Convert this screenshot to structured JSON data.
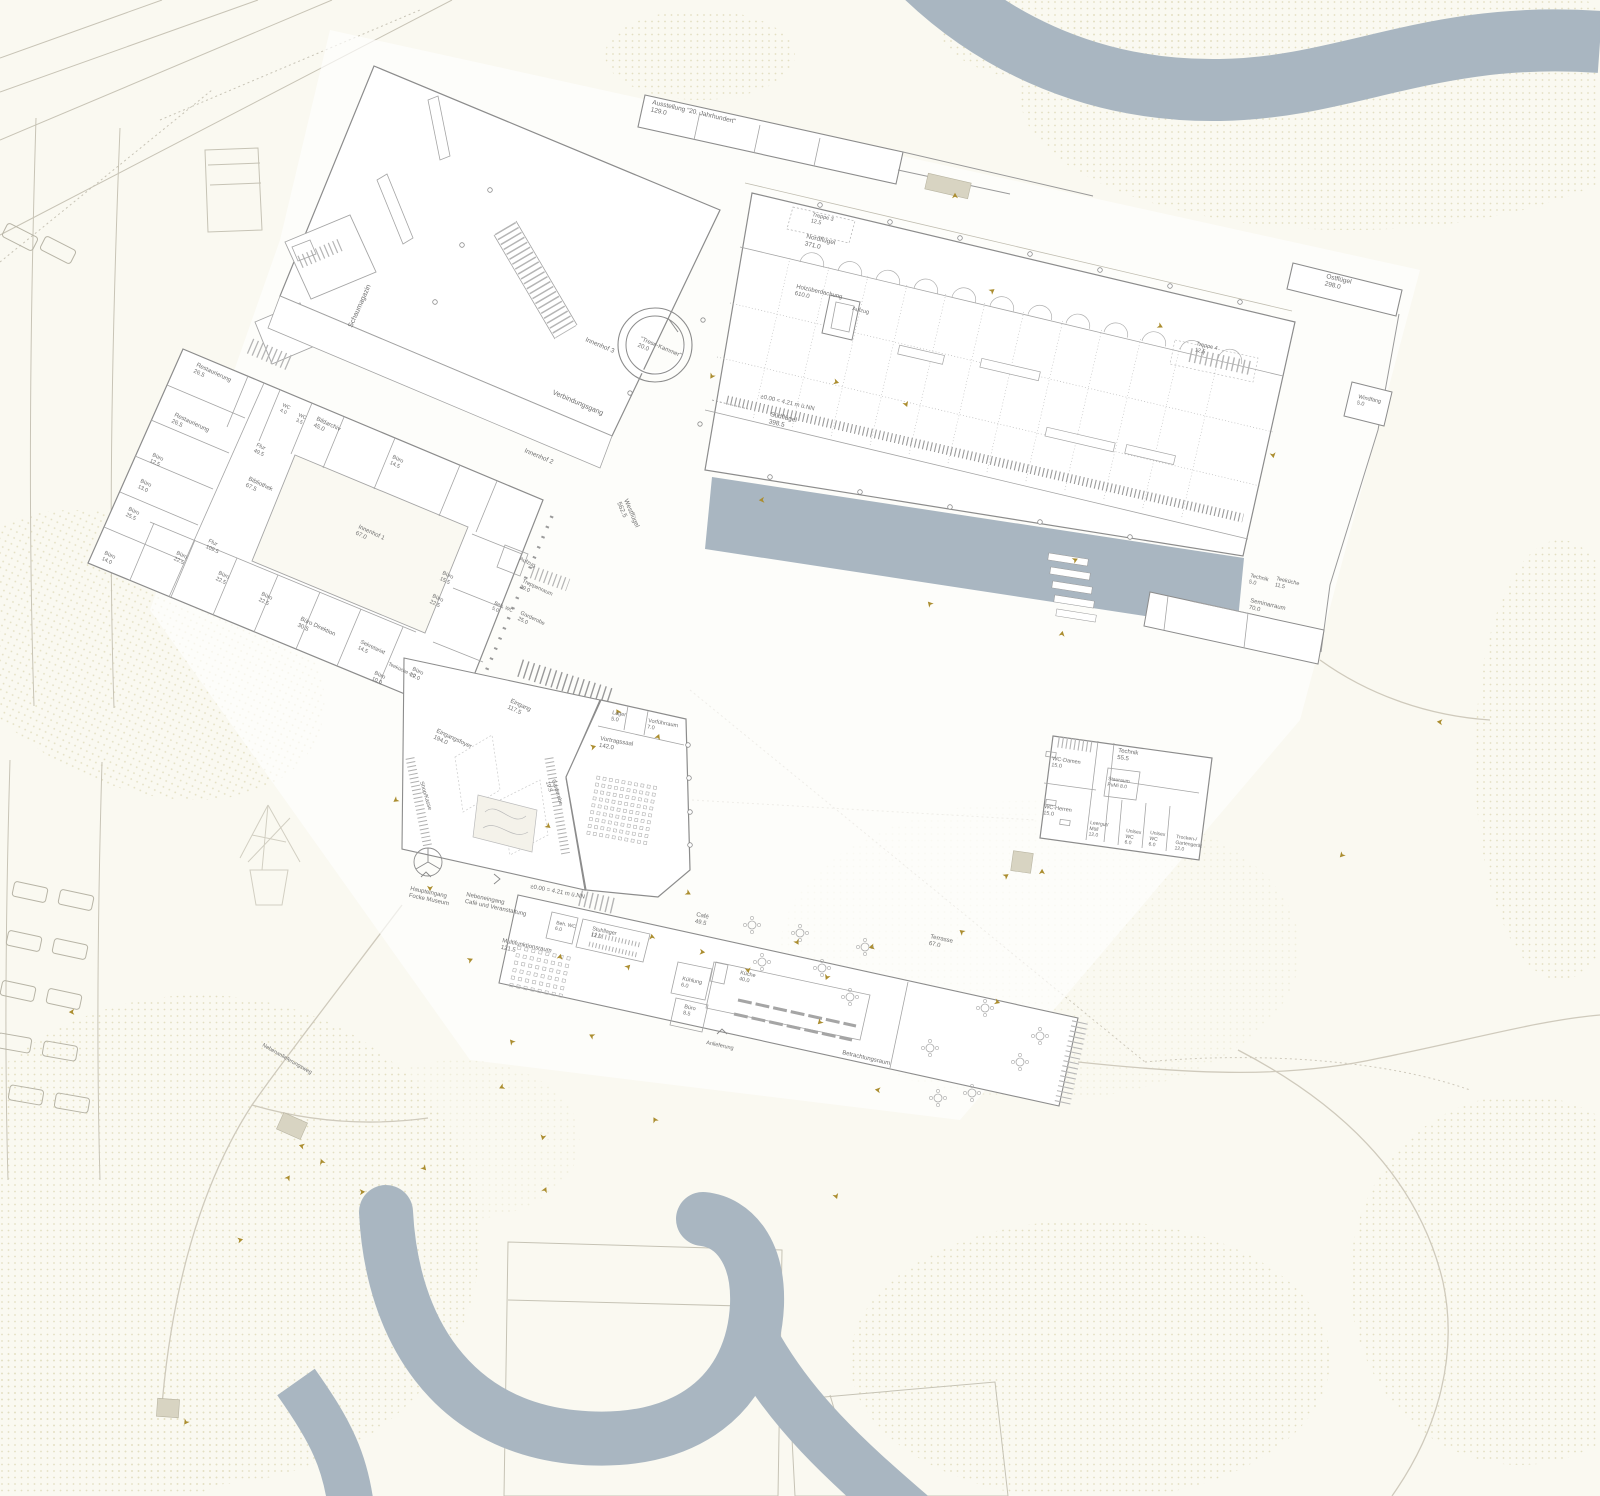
{
  "drawing": {
    "type": "architectural-site-plan",
    "elevation_note": "±0.00 = 4.21 m ü.NN"
  },
  "colors": {
    "paper": "#faf9f1",
    "water": "#a9b6c1",
    "building_fill": "#ffffff",
    "wall_stroke": "#8c8c8c",
    "inner_stroke": "#a5a5a5",
    "faint_stroke": "#c8c4b6",
    "dots": "#e3dfc2",
    "label": "#6e6e6e",
    "marker": "#ab8d2f",
    "shed_fill": "#d8d4c2"
  },
  "labels": [
    {
      "t": "Schaumagazin",
      "x": 352,
      "y": 328,
      "r": -66,
      "s": 7
    },
    {
      "t": "Innenhof 3",
      "x": 585,
      "y": 341,
      "r": 23,
      "s": 6.5
    },
    {
      "t": "Verbindungsgang",
      "x": 552,
      "y": 394,
      "r": 23,
      "s": 7
    },
    {
      "t": "Innenhof 2",
      "x": 524,
      "y": 452,
      "r": 23,
      "s": 6.5
    },
    {
      "t": "\"Trese-Kammer\"\n20.0",
      "x": 640,
      "y": 340,
      "r": 23,
      "s": 6
    },
    {
      "t": "Ausstellung \"20. Jahrhundert\"\n129.0",
      "x": 652,
      "y": 104,
      "r": 13,
      "s": 6.5
    },
    {
      "t": "Treppe 3\n12.5",
      "x": 812,
      "y": 216,
      "r": 13,
      "s": 5.5
    },
    {
      "t": "Nordflügel\n371.0",
      "x": 806,
      "y": 238,
      "r": 13,
      "s": 6.5
    },
    {
      "t": "Holzüberdachung\n610.0",
      "x": 796,
      "y": 288,
      "r": 13,
      "s": 6
    },
    {
      "t": "Aufzug",
      "x": 852,
      "y": 310,
      "r": 13,
      "s": 5.5
    },
    {
      "t": "±0.00 = 4.21 m ü.NN",
      "x": 760,
      "y": 398,
      "r": 13,
      "s": 6
    },
    {
      "t": "Südflügel\n398.5",
      "x": 770,
      "y": 416,
      "r": 13,
      "s": 6.5
    },
    {
      "t": "Treppe 4\n12.5",
      "x": 1196,
      "y": 345,
      "r": 13,
      "s": 5.5
    },
    {
      "t": "Ostflügel\n298.0",
      "x": 1326,
      "y": 278,
      "r": 13,
      "s": 6.5
    },
    {
      "t": "Windfang\n5.0",
      "x": 1358,
      "y": 398,
      "r": 13,
      "s": 5.5
    },
    {
      "t": "Technik\n5.0",
      "x": 1250,
      "y": 577,
      "r": 13,
      "s": 5.5
    },
    {
      "t": "Teeküche\n11.5",
      "x": 1276,
      "y": 580,
      "r": 13,
      "s": 5.5
    },
    {
      "t": "Seminarraum\n70.0",
      "x": 1250,
      "y": 602,
      "r": 13,
      "s": 6
    },
    {
      "t": "Restaurierung\n26.5",
      "x": 196,
      "y": 366,
      "r": 25,
      "s": 6
    },
    {
      "t": "Restaurierung\n26.5",
      "x": 174,
      "y": 416,
      "r": 25,
      "s": 6
    },
    {
      "t": "Büro\n12.5",
      "x": 152,
      "y": 456,
      "r": 25,
      "s": 5.5
    },
    {
      "t": "Büro\n13.0",
      "x": 140,
      "y": 482,
      "r": 25,
      "s": 5.5
    },
    {
      "t": "Büro\n25.5",
      "x": 128,
      "y": 510,
      "r": 25,
      "s": 5.5
    },
    {
      "t": "Büro\n14.0",
      "x": 104,
      "y": 554,
      "r": 25,
      "s": 5.5
    },
    {
      "t": "WC\n4.0",
      "x": 282,
      "y": 406,
      "r": 25,
      "s": 5
    },
    {
      "t": "WC\n3.5",
      "x": 298,
      "y": 416,
      "r": 25,
      "s": 5
    },
    {
      "t": "Bildarchiv\n45.0",
      "x": 316,
      "y": 420,
      "r": 25,
      "s": 6
    },
    {
      "t": "Büro\n14.5",
      "x": 392,
      "y": 458,
      "r": 25,
      "s": 5.5
    },
    {
      "t": "Flur\n49.5",
      "x": 256,
      "y": 446,
      "r": 25,
      "s": 5.5
    },
    {
      "t": "Bibliothek\n67.5",
      "x": 248,
      "y": 480,
      "r": 25,
      "s": 6
    },
    {
      "t": "Innenhof 1\n67.0",
      "x": 358,
      "y": 528,
      "r": 25,
      "s": 6
    },
    {
      "t": "Flur\n109.5",
      "x": 208,
      "y": 542,
      "r": 25,
      "s": 5.5
    },
    {
      "t": "Büro\n22.5",
      "x": 176,
      "y": 554,
      "r": 25,
      "s": 5.5
    },
    {
      "t": "Büro\n22.5",
      "x": 218,
      "y": 574,
      "r": 25,
      "s": 5.5
    },
    {
      "t": "Büro\n22.5",
      "x": 261,
      "y": 595,
      "r": 25,
      "s": 5.5
    },
    {
      "t": "Büro Direktion\n30.5",
      "x": 300,
      "y": 620,
      "r": 25,
      "s": 6
    },
    {
      "t": "Sekretariat\n14.5",
      "x": 360,
      "y": 643,
      "r": 25,
      "s": 5.5
    },
    {
      "t": "Teeküche 4.0",
      "x": 388,
      "y": 665,
      "r": 25,
      "s": 5
    },
    {
      "t": "Büro\n10.0",
      "x": 374,
      "y": 674,
      "r": 25,
      "s": 5.5
    },
    {
      "t": "Büro\n22.0",
      "x": 412,
      "y": 670,
      "r": 25,
      "s": 5.5
    },
    {
      "t": "Büro\n15.5",
      "x": 442,
      "y": 574,
      "r": 25,
      "s": 5.5
    },
    {
      "t": "Büro\n22.5",
      "x": 432,
      "y": 597,
      "r": 25,
      "s": 5.5
    },
    {
      "t": "Aufzug",
      "x": 519,
      "y": 560,
      "r": 25,
      "s": 5.5
    },
    {
      "t": "Treppenraum\n29.0",
      "x": 522,
      "y": 582,
      "r": 25,
      "s": 5.5
    },
    {
      "t": "Beh. WC\n5.0",
      "x": 494,
      "y": 604,
      "r": 25,
      "s": 5
    },
    {
      "t": "Garderobe\n25.0",
      "x": 520,
      "y": 614,
      "r": 25,
      "s": 5.5
    },
    {
      "t": "Westflügel\n562.5",
      "x": 624,
      "y": 500,
      "r": 67,
      "s": 6.5
    },
    {
      "t": "Eingang\n117.5",
      "x": 510,
      "y": 702,
      "r": 25,
      "s": 6
    },
    {
      "t": "Eingangsfoyer\n194.0",
      "x": 436,
      "y": 732,
      "r": 25,
      "s": 6
    },
    {
      "t": "Shop/Kasse",
      "x": 420,
      "y": 782,
      "r": 73,
      "s": 5.5
    },
    {
      "t": "Garderobe\n19.5",
      "x": 552,
      "y": 780,
      "r": 73,
      "s": 5.5
    },
    {
      "t": "Lager\n5.0",
      "x": 612,
      "y": 714,
      "r": 10,
      "s": 5.5
    },
    {
      "t": "Vorführraum\n7.0",
      "x": 648,
      "y": 722,
      "r": 10,
      "s": 5.5
    },
    {
      "t": "Vortragssaal\n142.0",
      "x": 600,
      "y": 740,
      "r": 10,
      "s": 6
    },
    {
      "t": "Haupteingang\nFocke Museum",
      "x": 410,
      "y": 890,
      "r": 12,
      "s": 6
    },
    {
      "t": "Nebeneingang\nCafé und Veranstaltung",
      "x": 466,
      "y": 896,
      "r": 12,
      "s": 6
    },
    {
      "t": "±0.00 = 4.21 m ü.NN",
      "x": 530,
      "y": 888,
      "r": 11,
      "s": 6
    },
    {
      "t": "Multifunktionsraum\n121.5",
      "x": 502,
      "y": 942,
      "r": 12,
      "s": 6
    },
    {
      "t": "Beh. WC\n6.0",
      "x": 556,
      "y": 924,
      "r": 12,
      "s": 5
    },
    {
      "t": "Stuhllager\n12.0",
      "x": 592,
      "y": 930,
      "r": 12,
      "s": 5.5
    },
    {
      "t": "Café\n49.5",
      "x": 696,
      "y": 916,
      "r": 12,
      "s": 6
    },
    {
      "t": "Kühlung\n6.0",
      "x": 682,
      "y": 980,
      "r": 12,
      "s": 5.5
    },
    {
      "t": "Küche\n40.0",
      "x": 740,
      "y": 974,
      "r": 12,
      "s": 5.5
    },
    {
      "t": "Büro\n8.5",
      "x": 684,
      "y": 1008,
      "r": 12,
      "s": 5.5
    },
    {
      "t": "Terrasse\n67.0",
      "x": 930,
      "y": 938,
      "r": 12,
      "s": 6
    },
    {
      "t": "Anlieferung",
      "x": 706,
      "y": 1044,
      "r": 12,
      "s": 5.5
    },
    {
      "t": "WC-Damen\n15.0",
      "x": 1052,
      "y": 760,
      "r": 8,
      "s": 5.5
    },
    {
      "t": "WC-Herren\n15.0",
      "x": 1044,
      "y": 808,
      "r": 8,
      "s": 5.5
    },
    {
      "t": "Technik\n55.5",
      "x": 1118,
      "y": 752,
      "r": 8,
      "s": 6
    },
    {
      "t": "Stauraum\nPuMi 8.0",
      "x": 1108,
      "y": 780,
      "r": 8,
      "s": 5
    },
    {
      "t": "Leergut/\nMüll\n12.0",
      "x": 1090,
      "y": 824,
      "r": 8,
      "s": 5
    },
    {
      "t": "Unisex\nWC\n6.0",
      "x": 1126,
      "y": 832,
      "r": 8,
      "s": 5
    },
    {
      "t": "Unisex\nWC\n6.0",
      "x": 1150,
      "y": 834,
      "r": 8,
      "s": 5
    },
    {
      "t": "Trocken-/\nGartengerät\n12.0",
      "x": 1176,
      "y": 838,
      "r": 8,
      "s": 5
    },
    {
      "t": "Betrachtungsraum",
      "x": 842,
      "y": 1054,
      "r": 13,
      "s": 6
    },
    {
      "t": "Nebenanlieferungsweg",
      "x": 262,
      "y": 1046,
      "r": 30,
      "s": 5.5
    }
  ],
  "markers": [
    [
      955,
      196
    ],
    [
      992,
      291
    ],
    [
      836,
      382
    ],
    [
      906,
      404
    ],
    [
      712,
      376
    ],
    [
      762,
      500
    ],
    [
      930,
      604
    ],
    [
      1062,
      634
    ],
    [
      1075,
      560
    ],
    [
      1160,
      326
    ],
    [
      1273,
      455
    ],
    [
      1342,
      855
    ],
    [
      1440,
      722
    ],
    [
      618,
      712
    ],
    [
      658,
      737
    ],
    [
      593,
      747
    ],
    [
      548,
      826
    ],
    [
      430,
      888
    ],
    [
      396,
      800
    ],
    [
      302,
      1146
    ],
    [
      322,
      1162
    ],
    [
      288,
      1178
    ],
    [
      362,
      1192
    ],
    [
      424,
      1168
    ],
    [
      543,
      1137
    ],
    [
      502,
      1087
    ],
    [
      592,
      1036
    ],
    [
      652,
      937
    ],
    [
      628,
      967
    ],
    [
      702,
      952
    ],
    [
      797,
      942
    ],
    [
      827,
      977
    ],
    [
      872,
      947
    ],
    [
      962,
      932
    ],
    [
      1042,
      872
    ],
    [
      1006,
      876
    ],
    [
      997,
      1002
    ],
    [
      836,
      1196
    ],
    [
      186,
      1422
    ],
    [
      72,
      1012
    ],
    [
      512,
      1042
    ],
    [
      560,
      957
    ],
    [
      470,
      960
    ],
    [
      688,
      893
    ],
    [
      748,
      970
    ],
    [
      820,
      1022
    ],
    [
      878,
      1090
    ],
    [
      655,
      1120
    ],
    [
      545,
      1190
    ],
    [
      240,
      1240
    ]
  ],
  "cars": [
    [
      30,
      892,
      12
    ],
    [
      76,
      900,
      12
    ],
    [
      24,
      941,
      12
    ],
    [
      70,
      949,
      12
    ],
    [
      18,
      991,
      12
    ],
    [
      64,
      999,
      12
    ],
    [
      14,
      1043,
      10
    ],
    [
      60,
      1051,
      10
    ],
    [
      26,
      1095,
      10
    ],
    [
      72,
      1103,
      10
    ],
    [
      20,
      237,
      27
    ],
    [
      58,
      250,
      27
    ]
  ],
  "sheds": [
    [
      948,
      186,
      44,
      16,
      13
    ],
    [
      292,
      1126,
      26,
      18,
      24
    ],
    [
      1022,
      862,
      20,
      20,
      8
    ],
    [
      168,
      1408,
      22,
      18,
      4
    ]
  ],
  "seat_grids": [
    {
      "x": 597,
      "y": 776,
      "rows": 9,
      "cols": 10,
      "px": 6.4,
      "py": 7.0,
      "size": 3,
      "rot": 10
    },
    {
      "x": 518,
      "y": 946,
      "rows": 6,
      "cols": 8,
      "px": 7.2,
      "py": 7.6,
      "size": 3.2,
      "rot": 12
    }
  ],
  "tables": [
    [
      752,
      925
    ],
    [
      800,
      933
    ],
    [
      762,
      962
    ],
    [
      822,
      968
    ],
    [
      865,
      947
    ],
    [
      850,
      997
    ],
    [
      930,
      1048
    ],
    [
      972,
      1093
    ],
    [
      1020,
      1062
    ],
    [
      985,
      1008
    ],
    [
      938,
      1098
    ],
    [
      1040,
      1036
    ]
  ],
  "scallop_rows": [
    {
      "x": 800,
      "y": 262,
      "rot": 13,
      "count": 12,
      "step": 39,
      "r": 12
    }
  ],
  "pillar_rows": [
    {
      "pts": [
        [
          820,
          205
        ],
        [
          890,
          222
        ],
        [
          960,
          238
        ],
        [
          1030,
          254
        ],
        [
          1100,
          270
        ],
        [
          1170,
          286
        ],
        [
          1240,
          302
        ]
      ]
    },
    {
      "pts": [
        [
          770,
          477
        ],
        [
          860,
          492
        ],
        [
          950,
          507
        ],
        [
          1040,
          522
        ],
        [
          1130,
          537
        ]
      ]
    },
    {
      "pts": [
        [
          688,
          745
        ],
        [
          689,
          778
        ],
        [
          690,
          812
        ],
        [
          690,
          845
        ]
      ]
    },
    {
      "pts": [
        [
          490,
          190
        ],
        [
          462,
          245
        ],
        [
          435,
          302
        ]
      ]
    }
  ]
}
